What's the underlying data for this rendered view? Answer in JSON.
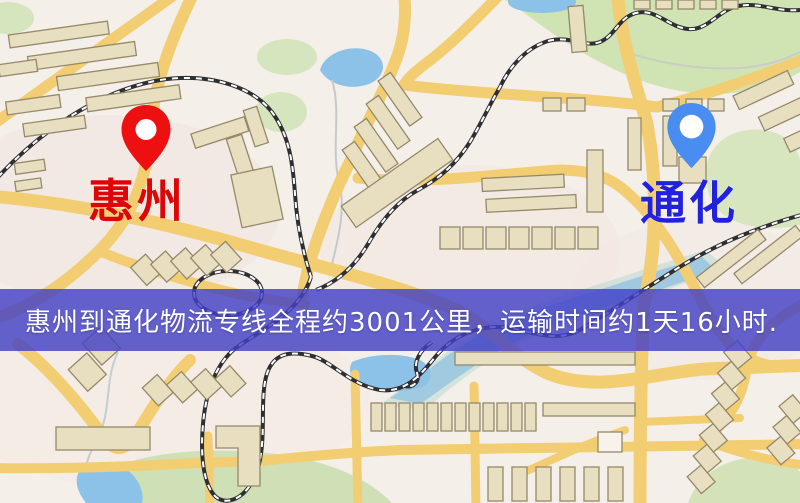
{
  "origin": {
    "label": "惠州",
    "pin_icon": "red-location-pin",
    "pin_color": "#ee1010",
    "label_color": "#dd0606"
  },
  "destination": {
    "label": "通化",
    "pin_icon": "blue-location-pin",
    "pin_color": "#4a8df0",
    "label_color": "#2222dd"
  },
  "banner": {
    "text": "惠州到通化物流专线全程约3001公里，运输时间约1天16小时.",
    "background_color": "#4341c6",
    "text_color": "#ffffff"
  },
  "route": {
    "distance_text": "约3001公里",
    "duration_text": "约1天16小时"
  },
  "map_colors": {
    "base": "#f4efe8",
    "road": "#f2cd72",
    "park": "#cfe3b3",
    "water": "#8cc2e8",
    "building": "#e8dfc0",
    "building_outline": "#95896a",
    "railway": "#2f2f33"
  }
}
